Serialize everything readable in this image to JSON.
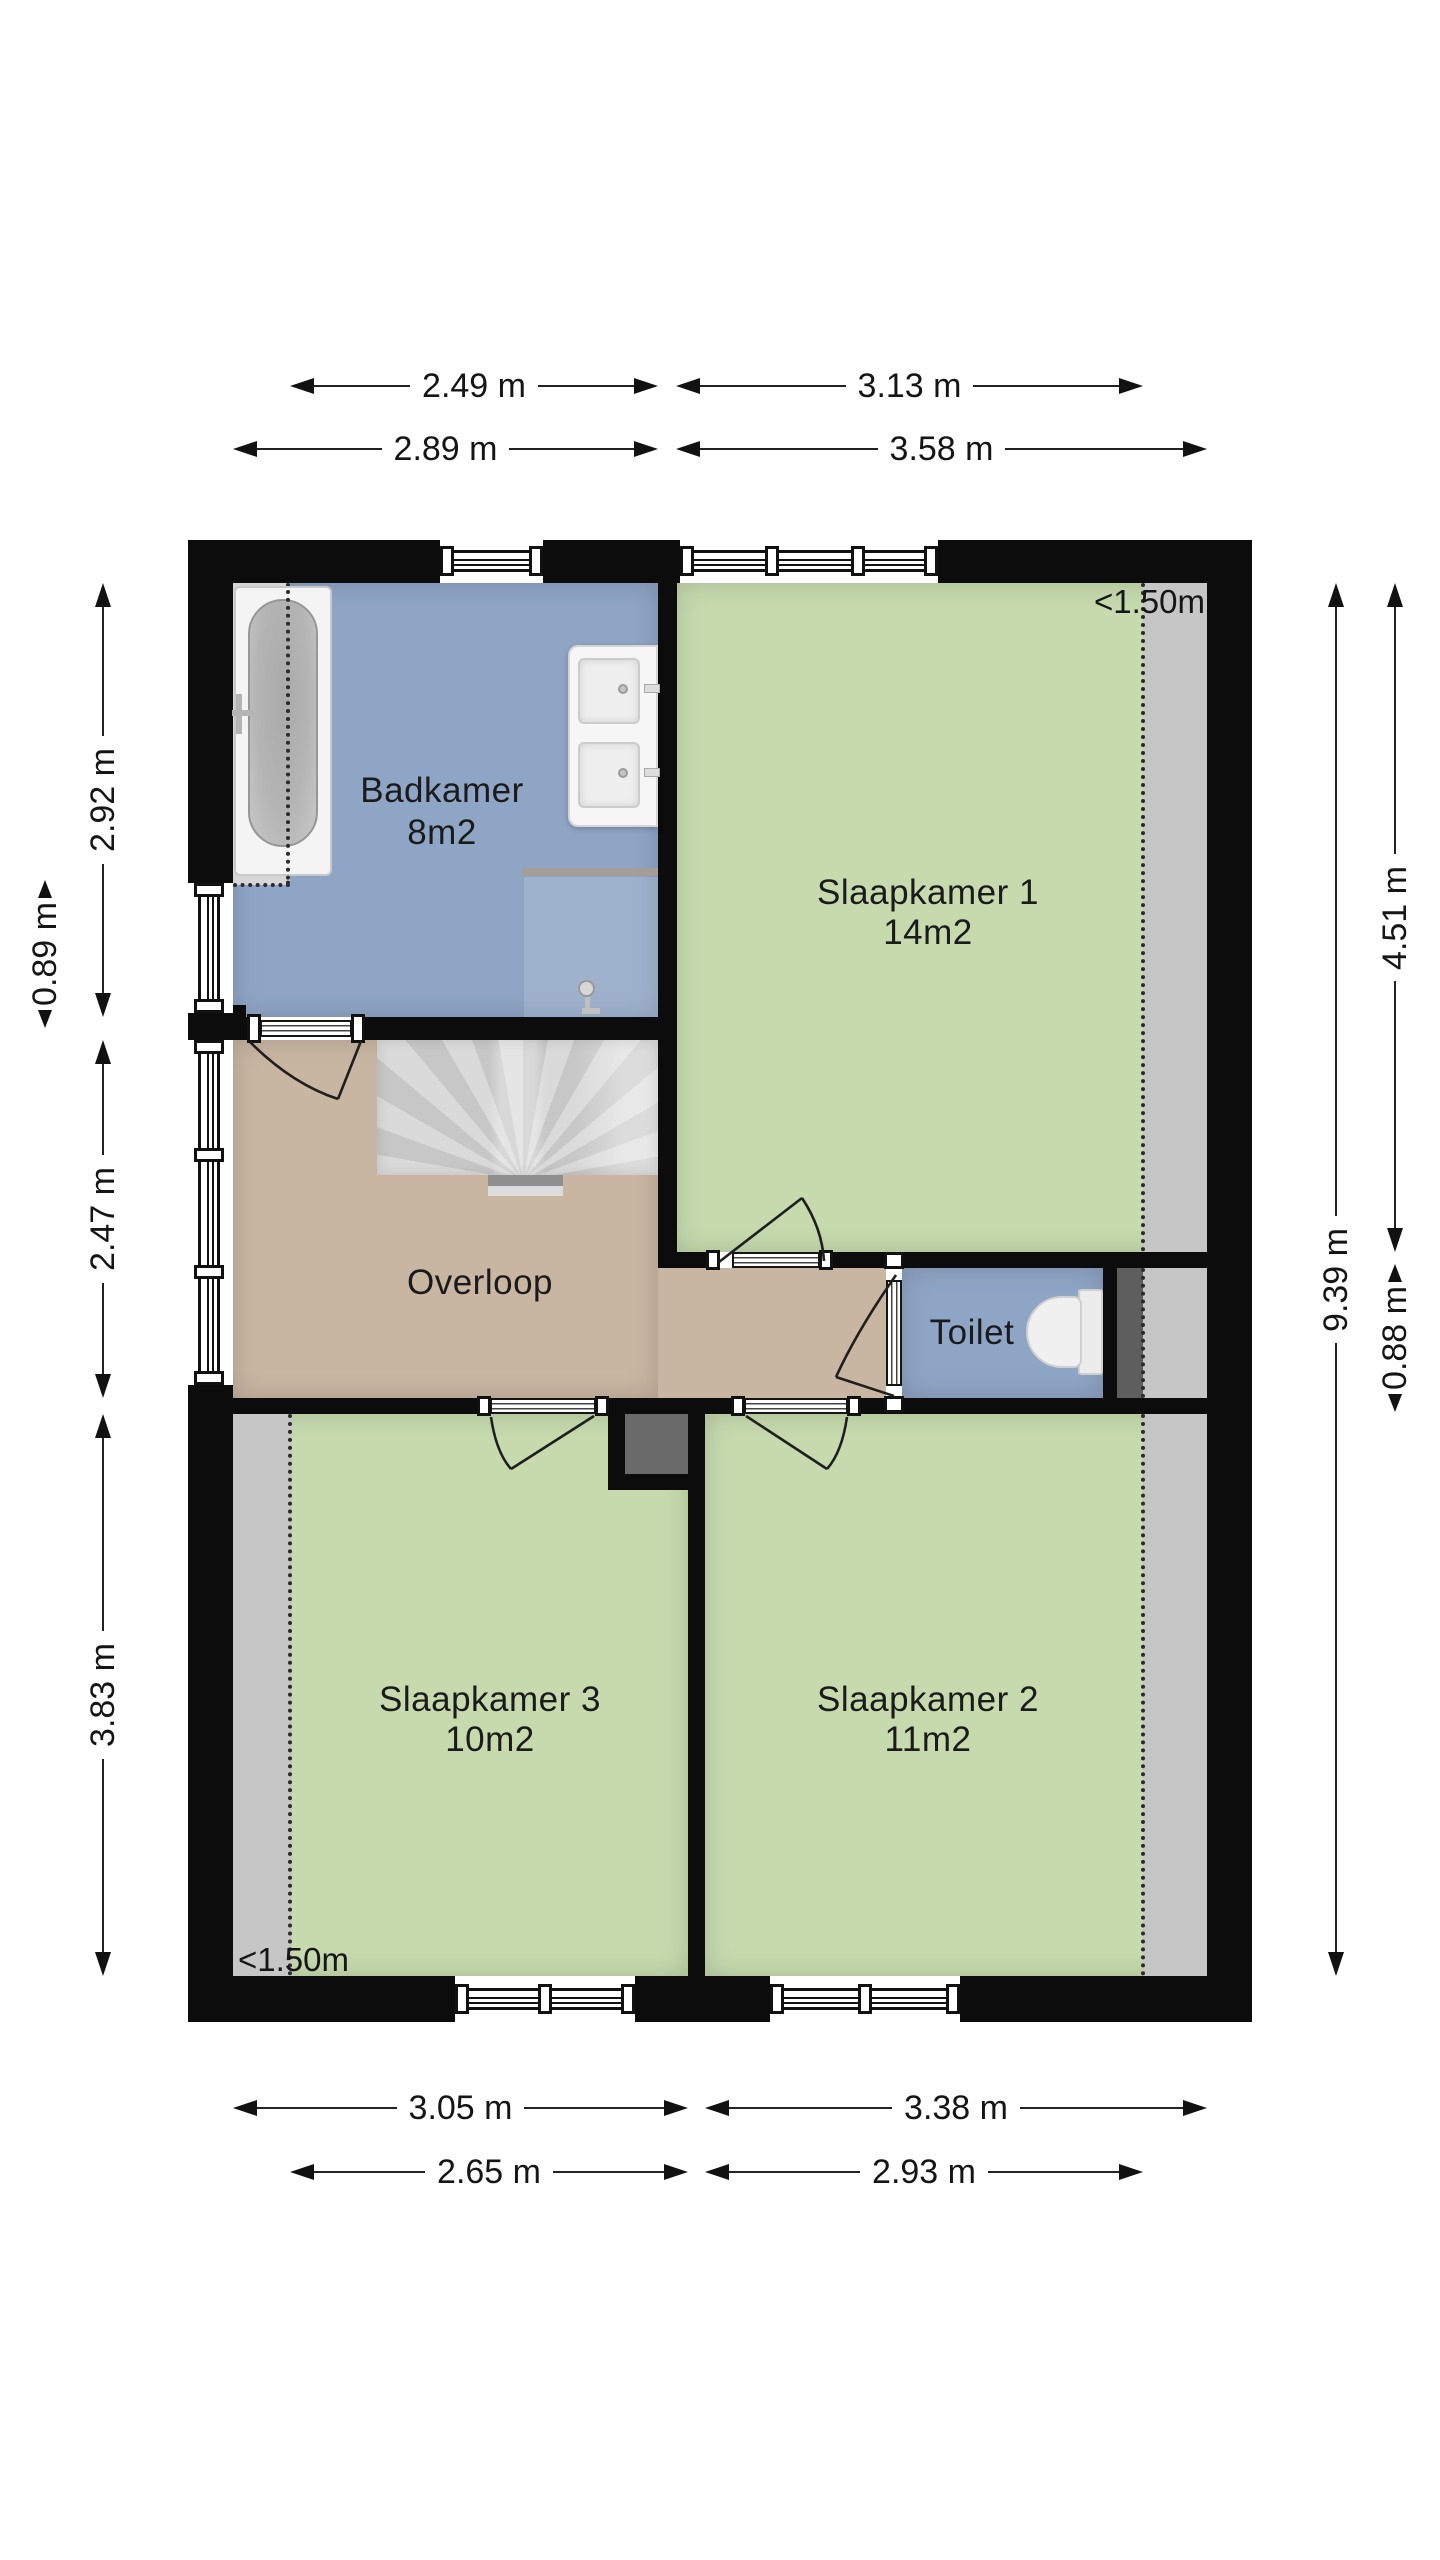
{
  "canvas": {
    "width": 1440,
    "height": 2560,
    "background": "#ffffff"
  },
  "colors": {
    "wall": "#0c0c0c",
    "bathroom_floor": "#8fa5c5",
    "bedroom_floor": "#c6daae",
    "landing_floor": "#c8b6a2",
    "low_headroom_zone": "#c6c6c6",
    "dark_zone": "#5e5e5e",
    "stairs": "#d2d2d2",
    "dimension_text": "#151515"
  },
  "rooms": {
    "badkamer": {
      "name": "Badkamer",
      "area": "8m2"
    },
    "slaapkamer1": {
      "name": "Slaapkamer 1",
      "area": "14m2"
    },
    "slaapkamer2": {
      "name": "Slaapkamer 2",
      "area": "11m2"
    },
    "slaapkamer3": {
      "name": "Slaapkamer 3",
      "area": "10m2"
    },
    "overloop": {
      "name": "Overloop"
    },
    "toilet": {
      "name": "Toilet"
    }
  },
  "headroom": {
    "top_right": "<1.50m",
    "bottom_left": "<1.50m"
  },
  "dimensions": {
    "top_inner": [
      "2.49 m",
      "3.13 m"
    ],
    "top_outer": [
      "2.89 m",
      "3.58 m"
    ],
    "bottom_inner": [
      "3.05 m",
      "3.38 m"
    ],
    "bottom_outer": [
      "2.65 m",
      "2.93 m"
    ],
    "left": [
      "2.92 m",
      "0.89 m",
      "2.47 m",
      "3.83 m"
    ],
    "right": [
      "4.51 m",
      "0.88 m",
      "9.39 m"
    ]
  }
}
